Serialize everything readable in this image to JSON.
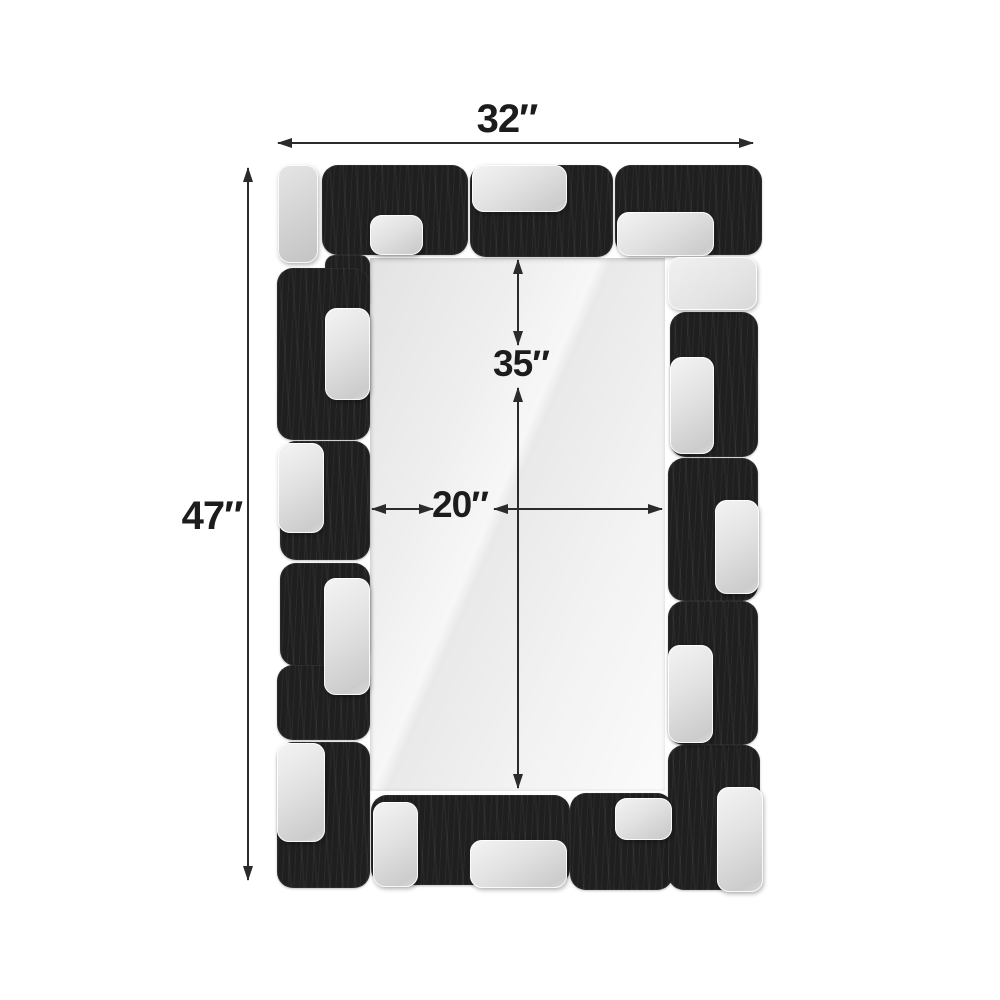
{
  "diagram": {
    "type": "product-dimension-diagram",
    "product": "rectangular wall mirror with black wood and silver block mosaic frame",
    "overall_width_label": "32″",
    "overall_height_label": "47″",
    "mirror_height_label": "35″",
    "mirror_width_label": "20″"
  },
  "colors": {
    "background": "#ffffff",
    "frame_black": "#1f1f1f",
    "accent_silver": "#d9d9d9",
    "mirror_glass": "#efefef",
    "dimension_line": "#2b2b2b",
    "label_text": "#1c1c1c"
  }
}
